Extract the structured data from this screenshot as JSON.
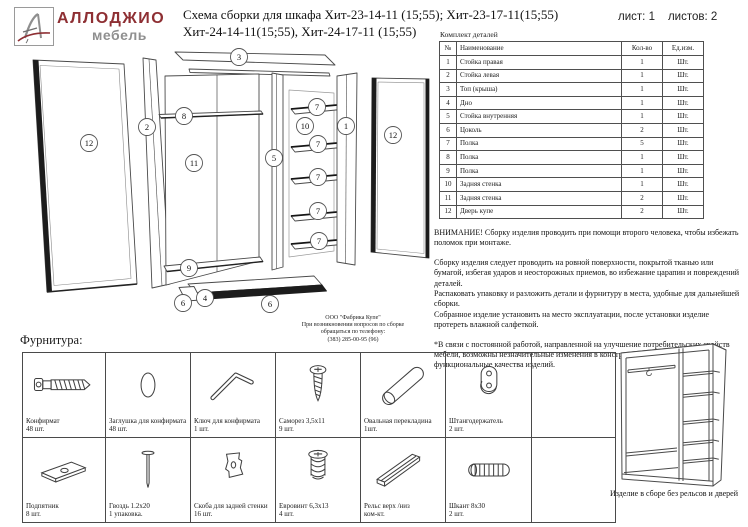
{
  "logo": {
    "monogram": "А",
    "brand": "АЛЛОДЖИО",
    "sub": "мебель",
    "brand_color": "#8e2f33",
    "sub_color": "#8f8f8f"
  },
  "title": {
    "line1": "Схема сборки для шкафа Хит-23-14-11 (15;55); Хит-23-17-11(15;55)",
    "line2": "Хит-24-14-11(15;55), Хит-24-17-11 (15;55)"
  },
  "sheet": {
    "list_label": "лист:",
    "list_value": "1",
    "total_label": "листов:",
    "total_value": "2"
  },
  "parts": {
    "caption": "Комплект деталей",
    "headers": [
      "№",
      "Наименование",
      "Кол-во",
      "Ед.изм."
    ],
    "rows": [
      [
        "1",
        "Стойка правая",
        "1",
        "Шт."
      ],
      [
        "2",
        "Стойка левая",
        "1",
        "Шт."
      ],
      [
        "3",
        "Топ (крыша)",
        "1",
        "Шт."
      ],
      [
        "4",
        "Дно",
        "1",
        "Шт."
      ],
      [
        "5",
        "Стойка внутренняя",
        "1",
        "Шт."
      ],
      [
        "6",
        "Цоколь",
        "2",
        "Шт."
      ],
      [
        "7",
        "Полка",
        "5",
        "Шт."
      ],
      [
        "8",
        "Полка",
        "1",
        "Шт."
      ],
      [
        "9",
        "Полка",
        "1",
        "Шт."
      ],
      [
        "10",
        "Задняя стенка",
        "1",
        "Шт."
      ],
      [
        "11",
        "Задняя стенка",
        "2",
        "Шт."
      ],
      [
        "12",
        "Дверь купе",
        "2",
        "Шт."
      ]
    ]
  },
  "notes": {
    "warning": "ВНИМАНИЕ! Сборку изделия проводить при помощи второго человека, чтобы избежать поломок при монтаже.",
    "handling": "Сборку изделия следует проводить на ровной поверхности, покрытой тканью или бумагой, избегая ударов и неосторожных приемов, во избежание царапин и повреждений деталей.\nРаспаковать упаковку и разложить детали и фурнитуру в места, удобные для дальнейшей сборки.\nСобранное изделие установить на место эксплуатации, после установки изделие протереть влажной салфеткой.",
    "disclaimer": "*В связи с постоянной работой, направленной на улучшение потребительских свойств мебели, возможны незначительные изменения в конструкции не влияющие на функциональные качества изделий."
  },
  "contact": {
    "lines": [
      "ООО \"Фабрика Купе\"",
      "При возникновении вопросов по сборке",
      "обращаться по телефону:",
      "(383) 285-00-95 (96)"
    ]
  },
  "hardware": {
    "section_title": "Фурнитура:",
    "items": [
      {
        "icon": "confirmat-screw",
        "name": "Конфирмат",
        "qty": "48 шт."
      },
      {
        "icon": "plug-cap",
        "name": "Заглушка для конфирмата",
        "qty": "48 шт."
      },
      {
        "icon": "hex-key",
        "name": "Ключ для конфирмата",
        "qty": "1 шт."
      },
      {
        "icon": "self-tapping-screw",
        "name": "Саморез 3,5х11",
        "qty": "9 шт."
      },
      {
        "icon": "oval-crossbar",
        "name": "Овальная перекладина",
        "qty": "1шт."
      },
      {
        "icon": "rod-holder",
        "name": "Штангодержатель",
        "qty": "2 шт."
      },
      {
        "icon": "empty",
        "name": "",
        "qty": ""
      },
      {
        "icon": "foot-plate",
        "name": "Подпятник",
        "qty": "8 шт."
      },
      {
        "icon": "nail",
        "name": "Гвоздь 1.2х20",
        "qty": "1 упаковка."
      },
      {
        "icon": "back-panel-clip",
        "name": "Скоба для задней стенки",
        "qty": "16 шт."
      },
      {
        "icon": "euro-screw",
        "name": "Евровинт 6,3х13",
        "qty": "4 шт."
      },
      {
        "icon": "rail",
        "name": "Рельс верх /низ",
        "qty": "ком-кт."
      },
      {
        "icon": "dowel",
        "name": "Шкант 8х30",
        "qty": "2 шт."
      },
      {
        "icon": "empty",
        "name": "",
        "qty": ""
      }
    ]
  },
  "diagram": {
    "callouts": [
      {
        "n": "3",
        "x": 227,
        "y": 9
      },
      {
        "n": "12",
        "x": 77,
        "y": 95
      },
      {
        "n": "2",
        "x": 135,
        "y": 79
      },
      {
        "n": "8",
        "x": 172,
        "y": 68
      },
      {
        "n": "11",
        "x": 182,
        "y": 115
      },
      {
        "n": "9",
        "x": 177,
        "y": 220
      },
      {
        "n": "5",
        "x": 262,
        "y": 110
      },
      {
        "n": "10",
        "x": 293,
        "y": 78
      },
      {
        "n": "7",
        "x": 305,
        "y": 59
      },
      {
        "n": "7",
        "x": 306,
        "y": 96
      },
      {
        "n": "7",
        "x": 306,
        "y": 129
      },
      {
        "n": "7",
        "x": 306,
        "y": 163
      },
      {
        "n": "7",
        "x": 307,
        "y": 193
      },
      {
        "n": "1",
        "x": 334,
        "y": 78
      },
      {
        "n": "12",
        "x": 381,
        "y": 87
      },
      {
        "n": "6",
        "x": 171,
        "y": 255
      },
      {
        "n": "4",
        "x": 193,
        "y": 250
      },
      {
        "n": "6",
        "x": 258,
        "y": 256
      }
    ]
  },
  "assembled": {
    "caption": "Изделие в сборе без рельсов и дверей"
  }
}
